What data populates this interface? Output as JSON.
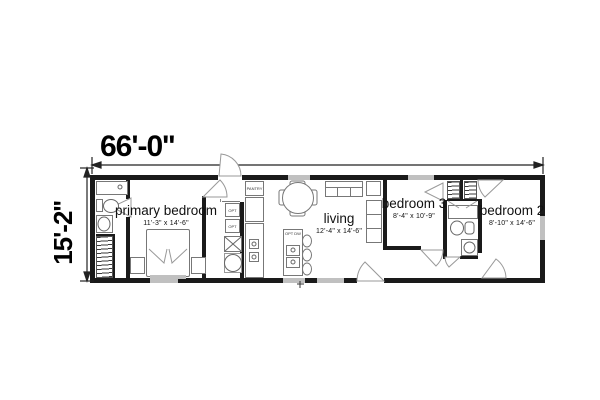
{
  "dimensions": {
    "overall_width": "66'-0''",
    "overall_height": "15'-2''"
  },
  "rooms": {
    "primary_bedroom": {
      "name": "primary bedroom",
      "size": "11'-3\" x 14'-6\""
    },
    "living": {
      "name": "living",
      "size": "12'-4\" x 14'-6\""
    },
    "bedroom3": {
      "name": "bedroom 3",
      "size": "8'-4\" x 10'-9\""
    },
    "bedroom2": {
      "name": "bedroom 2",
      "size": "8'-10\" x 14'-6\""
    }
  },
  "labels": {
    "pantry": "PANTRY",
    "island_dishwasher": "OPT DW",
    "opt_appliance_1": "OPT",
    "opt_appliance_2": "OPT"
  },
  "colors": {
    "wall": "#1a1a1a",
    "fixture_line": "#777777",
    "window": "#c0c0c0",
    "background": "#ffffff"
  }
}
